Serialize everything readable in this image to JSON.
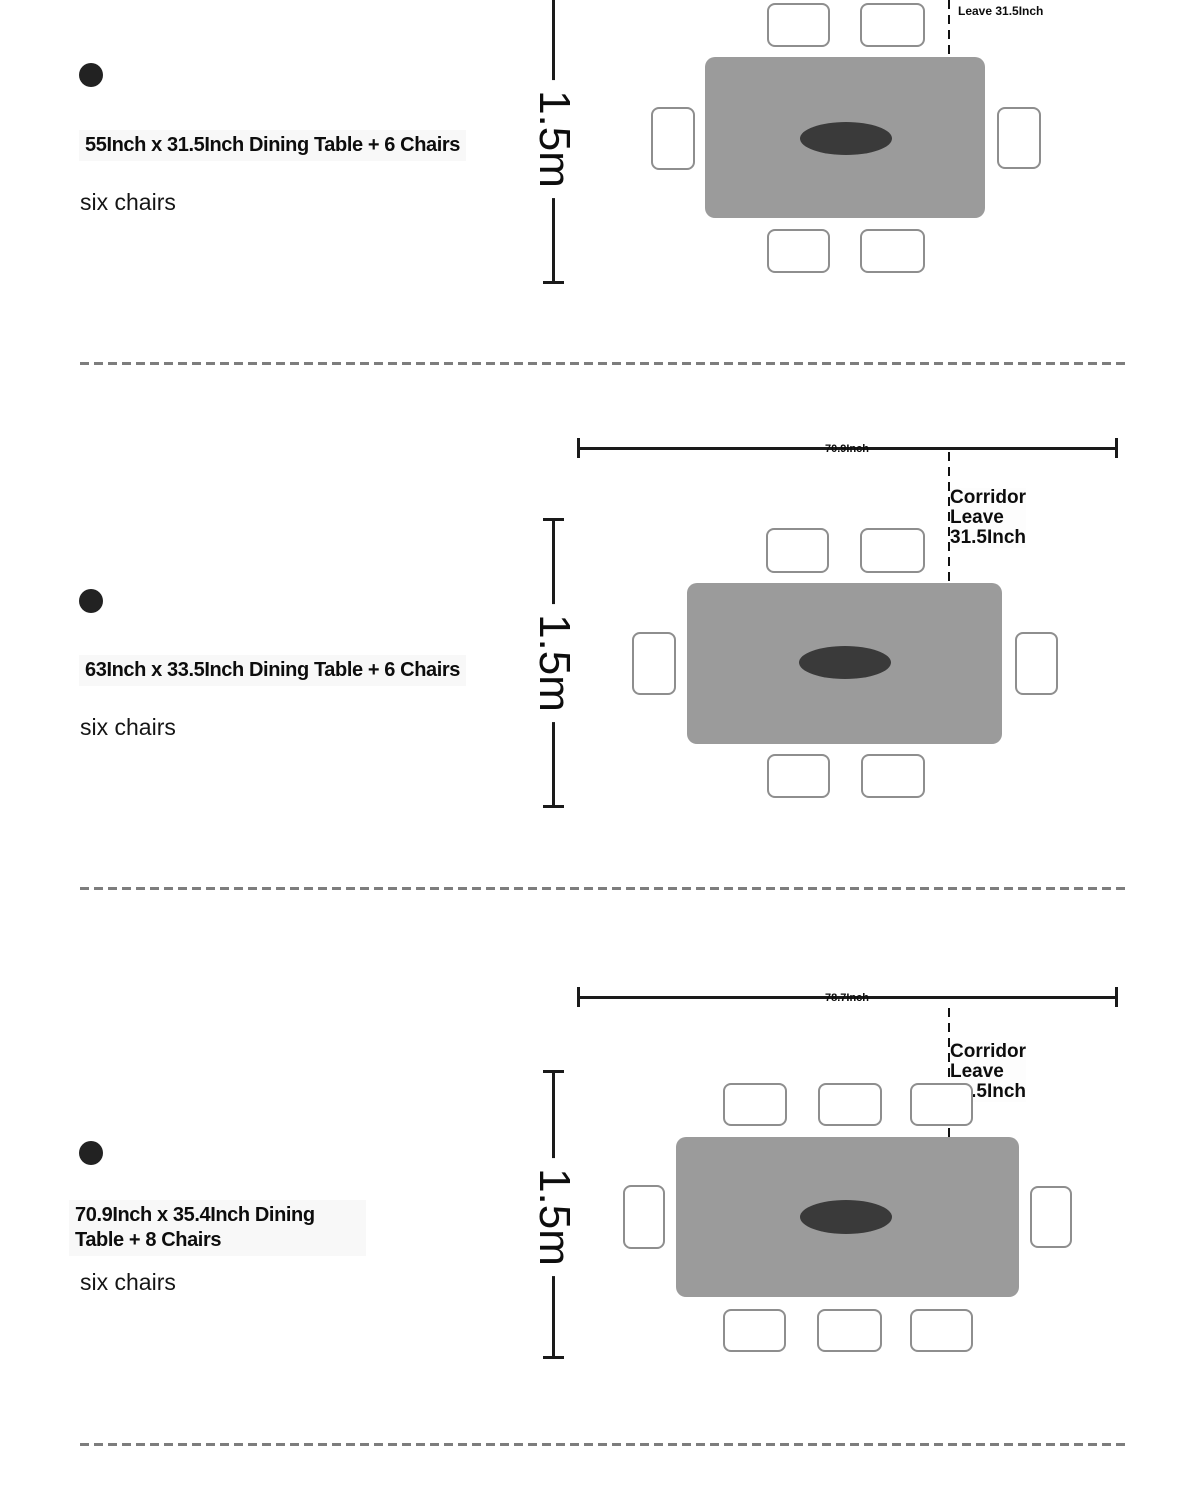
{
  "sections": [
    {
      "title": "55Inch x 31.5Inch Dining Table + 6 Chairs",
      "subtitle": "six chairs",
      "chair_count": 6,
      "vertical_dimension_label": "1.5m",
      "corridor_label": "Leave 31.5Inch"
    },
    {
      "title": "63Inch x 33.5Inch Dining Table + 6 Chairs",
      "subtitle": "six chairs",
      "chair_count": 6,
      "vertical_dimension_label": "1.5m",
      "width_dimension_label": "70.9Inch",
      "corridor_label_lines": [
        "Corridor",
        "Leave",
        "31.5Inch"
      ]
    },
    {
      "title": "70.9Inch x 35.4Inch Dining Table + 8 Chairs",
      "subtitle": "six chairs",
      "chair_count": 8,
      "vertical_dimension_label": "1.5m",
      "width_dimension_label": "78.7Inch",
      "corridor_label_lines": [
        "Corridor",
        "Leave",
        "31.5Inch"
      ]
    }
  ],
  "colors": {
    "table_fill": "#9b9b9b",
    "centerpiece_fill": "#3a3a3a",
    "chair_border": "#8e8e8e",
    "dimension_line": "#1a1a1a",
    "separator": "#7d7d7d"
  }
}
